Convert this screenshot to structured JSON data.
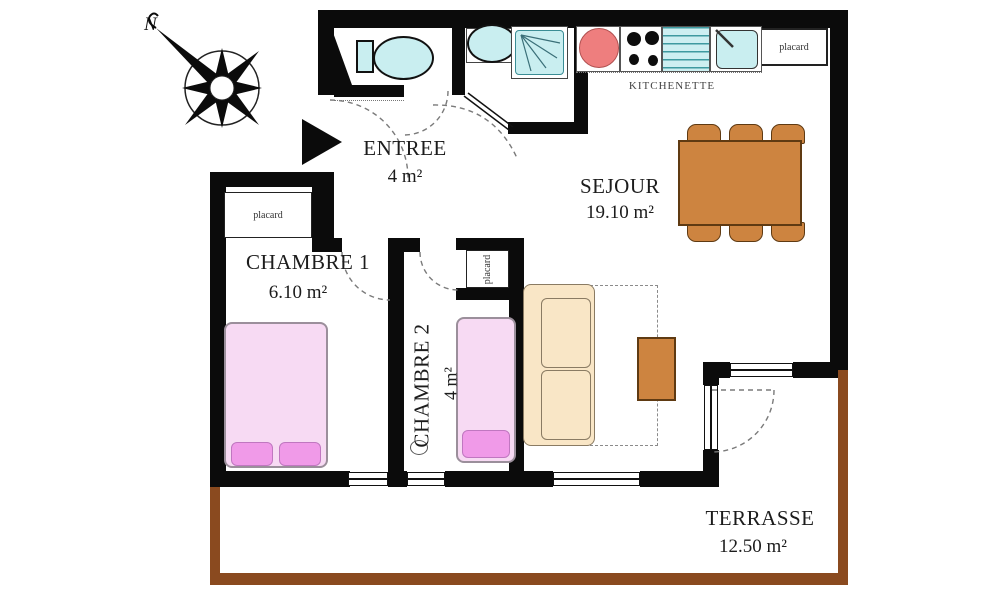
{
  "title": "Apartment floor plan",
  "compass": {
    "north_label": "N"
  },
  "rooms": {
    "entree": {
      "name": "ENTREE",
      "area": "4 m²"
    },
    "sejour": {
      "name": "SEJOUR",
      "area": "19.10 m²"
    },
    "chambre1": {
      "name": "CHAMBRE 1",
      "area": "6.10 m²"
    },
    "chambre2": {
      "name": "CHAMBRE 2",
      "area": "4 m²"
    },
    "terrasse": {
      "name": "TERRASSE",
      "area": "12.50 m²"
    },
    "kitchenette": {
      "name": "KITCHENETTE"
    }
  },
  "closets": {
    "kitchen_label": "placard",
    "chambre1_label": "placard",
    "chambre2_label": "placard"
  },
  "colors": {
    "wall": "#0b0b0b",
    "terrace_border": "#8a4a1f",
    "fixture_cyan": "#c9eef0",
    "hotplate_red": "#ee7e7e",
    "wood_brown": "#cd8440",
    "sofa_tan": "#f9e6c6",
    "bed_pink": "#f7daf3",
    "pillow_pink": "#f09ae8"
  }
}
